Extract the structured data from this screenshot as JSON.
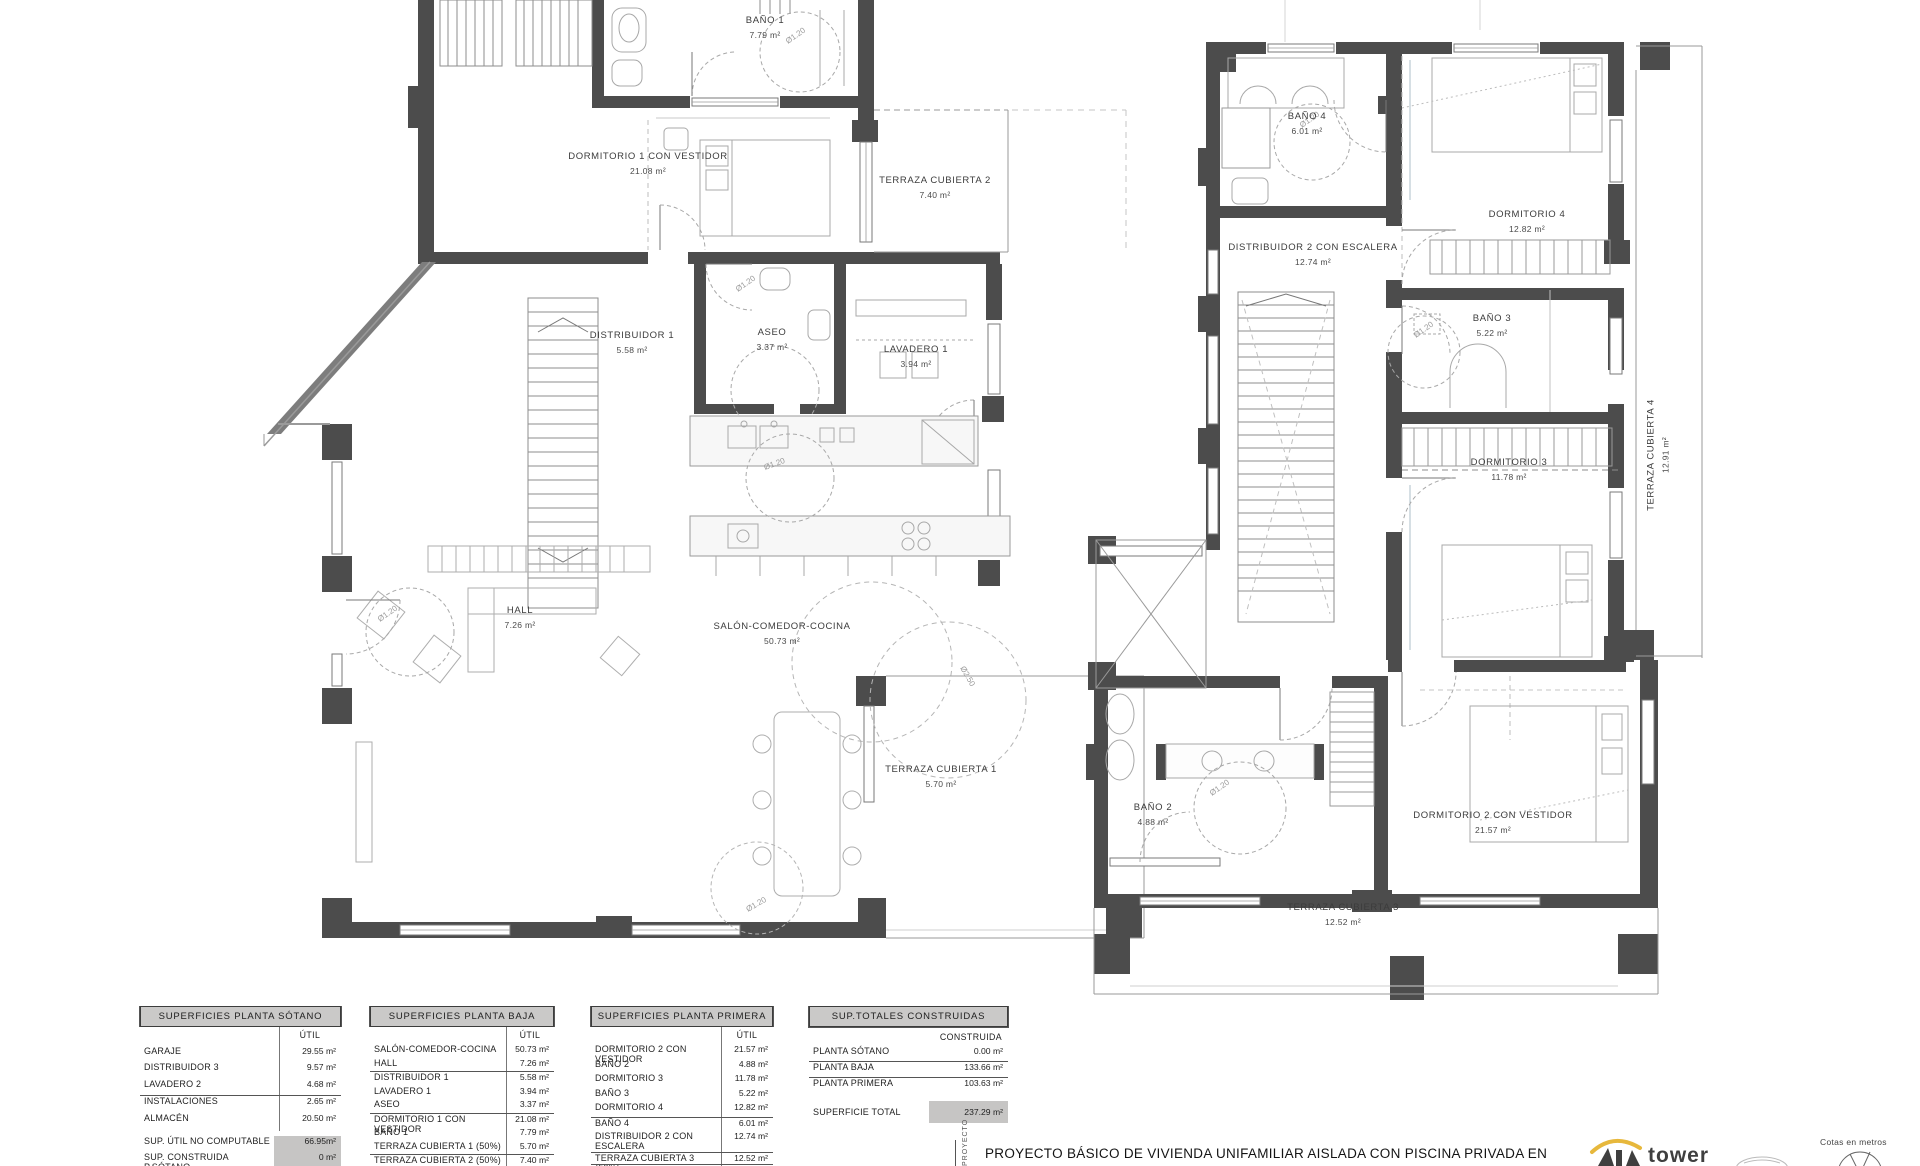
{
  "plans": {
    "baja": {
      "rooms": {
        "bano1": {
          "name": "BAÑO 1",
          "area": "7.79 m²"
        },
        "dormitorio1": {
          "name": "DORMITORIO 1 CON VESTIDOR",
          "area": "21.08 m²"
        },
        "terraza2": {
          "name": "TERRAZA CUBIERTA 2",
          "area": "7.40 m²"
        },
        "distribuidor1": {
          "name": "DISTRIBUIDOR 1",
          "area": "5.58 m²"
        },
        "aseo": {
          "name": "ASEO",
          "area": "3.37 m²"
        },
        "lavadero1": {
          "name": "LAVADERO 1",
          "area": "3.94 m²"
        },
        "hall": {
          "name": "HALL",
          "area": "7.26 m²"
        },
        "salon": {
          "name": "SALÓN-COMEDOR-COCINA",
          "area": "50.73 m²"
        },
        "terraza1": {
          "name": "TERRAZA CUBIERTA 1",
          "area": "5.70 m²"
        }
      }
    },
    "primera": {
      "rooms": {
        "bano4": {
          "name": "BAÑO 4",
          "area": "6.01 m²"
        },
        "dormitorio4": {
          "name": "DORMITORIO 4",
          "area": "12.82 m²"
        },
        "distribuidor2": {
          "name": "DISTRIBUIDOR 2 CON ESCALERA",
          "area": "12.74 m²"
        },
        "bano3": {
          "name": "BAÑO 3",
          "area": "5.22 m²"
        },
        "dormitorio3": {
          "name": "DORMITORIO 3",
          "area": "11.78 m²"
        },
        "terraza4": {
          "name": "TERRAZA CUBIERTA 4",
          "area": "12.91 m²"
        },
        "bano2": {
          "name": "BAÑO 2",
          "area": "4.88 m²"
        },
        "dormitorio2": {
          "name": "DORMITORIO 2 CON VESTIDOR",
          "area": "21.57 m²"
        },
        "terraza3": {
          "name": "TERRAZA CUBIERTA 3",
          "area": "12.52 m²"
        }
      }
    }
  },
  "annotations": {
    "circle_small": "Ø1.20",
    "circle_big": "Ø2.50"
  },
  "tables": {
    "sotano": {
      "title": "SUPERFICIES PLANTA SÓTANO",
      "col": "ÚTIL",
      "rows": [
        {
          "label": "GARAJE",
          "value": "29.55 m²"
        },
        {
          "label": "DISTRIBUIDOR 3",
          "value": "9.57 m²"
        },
        {
          "label": "LAVADERO 2",
          "value": "4.68 m²"
        },
        {
          "label": "INSTALACIONES",
          "value": "2.65 m²"
        },
        {
          "label": "ALMACÉN",
          "value": "20.50 m²"
        }
      ],
      "footer": [
        {
          "label": "SUP. ÚTIL NO COMPUTABLE",
          "value": "66.95m²"
        },
        {
          "label": "SUP. CONSTRUIDA P.SÓTANO",
          "value": "0 m²"
        }
      ]
    },
    "baja": {
      "title": "SUPERFICIES PLANTA BAJA",
      "col": "ÚTIL",
      "rows": [
        {
          "label": "SALÓN-COMEDOR-COCINA",
          "value": "50.73 m²"
        },
        {
          "label": "HALL",
          "value": "7.26 m²"
        },
        {
          "label": "DISTRIBUIDOR 1",
          "value": "5.58 m²"
        },
        {
          "label": "LAVADERO 1",
          "value": "3.94 m²"
        },
        {
          "label": "ASEO",
          "value": "3.37 m²"
        },
        {
          "label": "DORMITORIO 1 CON VESTIDOR",
          "value": "21.08 m²"
        },
        {
          "label": "BAÑO 1",
          "value": "7.79 m²"
        },
        {
          "label": "TERRAZA CUBIERTA 1 (50%)",
          "value": "5.70 m²"
        },
        {
          "label": "TERRAZA CUBIERTA 2 (50%)",
          "value": "7.40 m²"
        }
      ]
    },
    "primera": {
      "title": "SUPERFICIES PLANTA PRIMERA",
      "col": "ÚTIL",
      "rows": [
        {
          "label": "DORMITORIO 2 CON VESTIDOR",
          "value": "21.57 m²"
        },
        {
          "label": "BAÑO 2",
          "value": "4.88 m²"
        },
        {
          "label": "DORMITORIO 3",
          "value": "11.78 m²"
        },
        {
          "label": "BAÑO 3",
          "value": "5.22 m²"
        },
        {
          "label": "DORMITORIO 4",
          "value": "12.82 m²"
        },
        {
          "label": "BAÑO 4",
          "value": "6.01 m²"
        },
        {
          "label": "DISTRIBUIDOR 2 CON ESCALERA",
          "value": "12.74 m²"
        },
        {
          "label": "TERRAZA CUBIERTA 3 (50%)",
          "value": "12.52 m²"
        },
        {
          "label": "TERRAZA CUBIERTA 4 (50%)",
          "value": "12.91 m²"
        }
      ]
    },
    "totales": {
      "title": "SUP.TOTALES CONSTRUIDAS",
      "col": "CONSTRUIDA",
      "rows": [
        {
          "label": "PLANTA SÓTANO",
          "value": "0.00 m²"
        },
        {
          "label": "PLANTA BAJA",
          "value": "133.66 m²"
        },
        {
          "label": "PLANTA PRIMERA",
          "value": "103.63 m²"
        }
      ],
      "total": {
        "label": "SUPERFICIE TOTAL",
        "value": "237.29 m²"
      }
    }
  },
  "titleblock": {
    "vertical_label": "PROYECTO",
    "project_title": "PROYECTO BÁSICO DE VIVIENDA UNIFAMILIAR AISLADA CON PISCINA PRIVADA EN",
    "cotas": "Cotas en metros",
    "logo_text": "tower"
  },
  "colors": {
    "wall": "#4c4c4c",
    "thin_line": "#9a9a9a",
    "table_header_bg": "#cac9c8",
    "accent_yellow": "#e7b83c"
  }
}
